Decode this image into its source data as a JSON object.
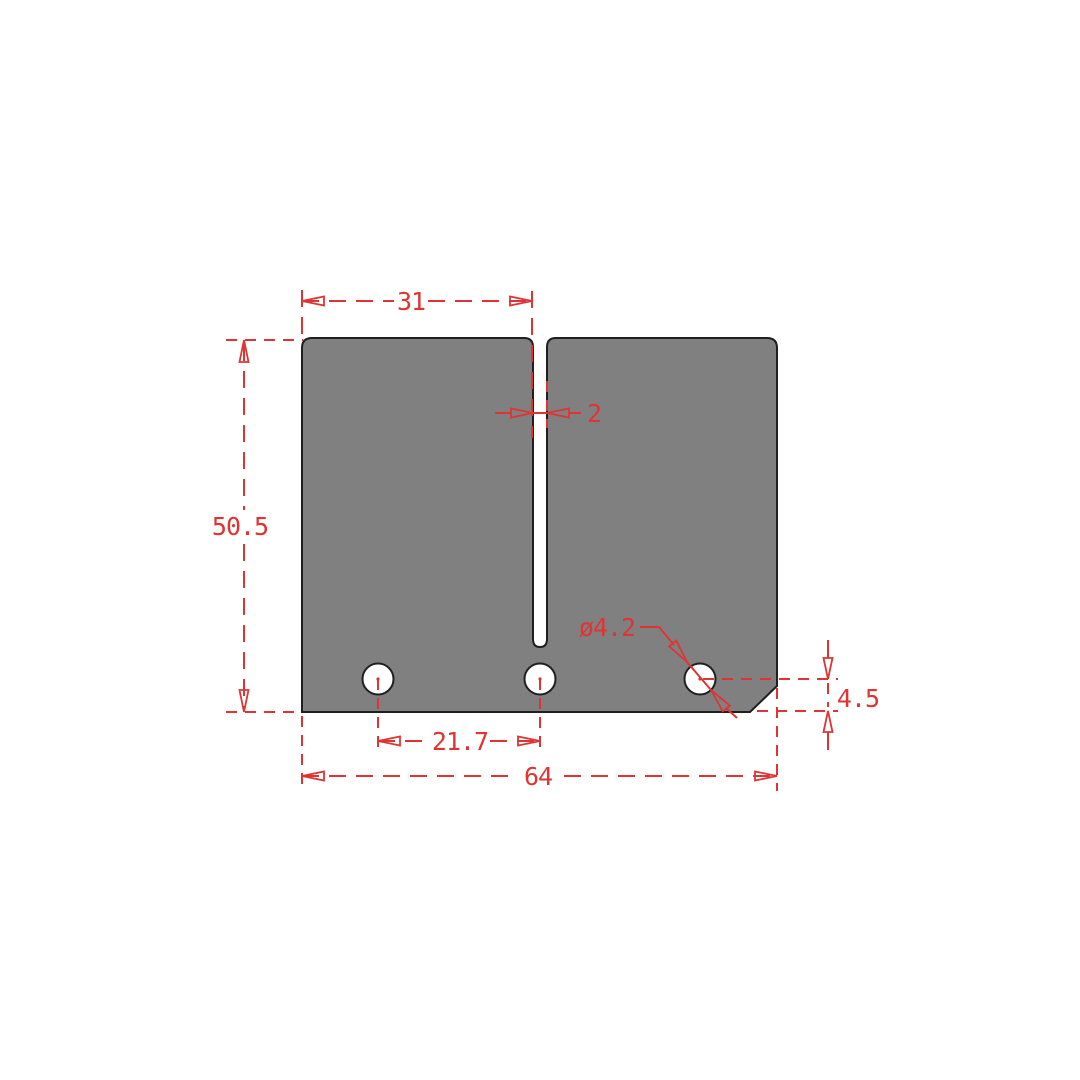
{
  "drawing": {
    "title": "reed-petal-dimension-drawing",
    "colors": {
      "background": "#ffffff",
      "part_fill": "#808080",
      "outline": "#1f1f1f",
      "dimension": "#df3434"
    },
    "dimensions": {
      "top_width": "31",
      "slot_width": "2",
      "overall_height": "50.5",
      "hole_spacing": "21.7",
      "overall_width": "64",
      "hole_diameter": "ø4.2",
      "hole_edge_offset": "4.5"
    }
  }
}
